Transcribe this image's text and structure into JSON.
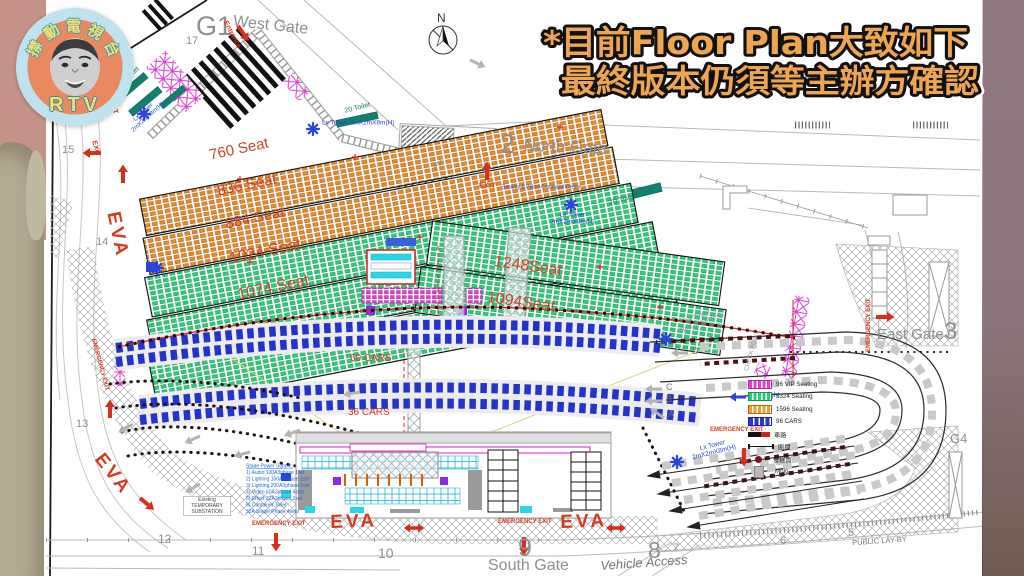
{
  "headline": {
    "line1": "*目前Floor Plan大致如下",
    "line2": "最終版本仍須等主辦方確認"
  },
  "logo": {
    "station_chars": [
      "㩒",
      "動",
      "電",
      "視",
      "台"
    ],
    "abbr": "RTV"
  },
  "plan": {
    "gates": {
      "west_code": "G1",
      "west": "West Gate",
      "north_code": "2",
      "north": "North Gate",
      "east": "East Gate",
      "east_code": "3",
      "south": "South Gate",
      "g4": "G4"
    },
    "roads": {
      "vehicle_access": "Vehicle Access",
      "public_layby": "PUBLIC LAY-BY"
    },
    "markers": {
      "north_arrow": "N",
      "ph": "PH",
      "checkpoint": "CHECK POINT",
      "day_light": "Day Light",
      "command_center": "Security & Police Command Center"
    },
    "numbers": {
      "n5": "5",
      "n6": "6",
      "n7": "7",
      "n8": "8",
      "n9": "9",
      "n10": "10",
      "n11": "11",
      "n12": "12",
      "n13": "13",
      "n14": "14",
      "n15": "15",
      "n16": "16",
      "n17": "17"
    },
    "sections": {
      "s760": "760 Seat",
      "s836": "836 Seat",
      "s884": "884 Seat",
      "s1024": "1024 Seat",
      "s1074": "1074 Seat",
      "s1248": "1248Seat",
      "s1094": "1094Seat"
    },
    "parking": {
      "c60": "60 CARS",
      "c36": "36 CARS"
    },
    "labels": {
      "eva": "EVA",
      "exit": "EXIT",
      "entrance": "Entrance",
      "emergency": "EMERGENCY EXIT"
    },
    "tower": {
      "name": "Lx Tower",
      "size": "2mX2mX8m(H)"
    },
    "toilet": {
      "t2d": "2D Toilet",
      "t20": "20 Toilet"
    },
    "queue_letters": {
      "a": "A",
      "b": "B",
      "c": "C",
      "d": "D"
    },
    "legend": {
      "items": [
        {
          "type": "vip",
          "label": "96 VIP Seating"
        },
        {
          "type": "seating-green",
          "label": "5324 Seating"
        },
        {
          "type": "seating-orange",
          "label": "1596 Seating"
        },
        {
          "type": "cars",
          "label": "96 CARS"
        },
        {
          "type": "road",
          "label": "車路"
        },
        {
          "type": "fence",
          "label": "圍欄"
        },
        {
          "type": "cone",
          "label": "雪糕筒"
        },
        {
          "type": "mojo",
          "label": "Mojo"
        }
      ]
    },
    "power": {
      "title": "Stage Power Supply:",
      "lines": [
        "1) Audio 100A3phase 1set",
        "2) Lighting 100A3phase 1set",
        "3) Lighting 200A3phase 1set",
        "4) Video 60A3phase 4sets",
        "5) Effect 32A3phase 1set",
        "6) Container Toilet",
        "32A Single Phase 4sets"
      ]
    },
    "substation": "Existing TEMPORARY SUBSTATION"
  },
  "colors": {
    "seat_orange": "#e78a2a",
    "seat_green": "#34c87e",
    "vip_magenta": "#e040d0",
    "car_blue": "#2433c8",
    "headline_orange": "#eda550"
  }
}
